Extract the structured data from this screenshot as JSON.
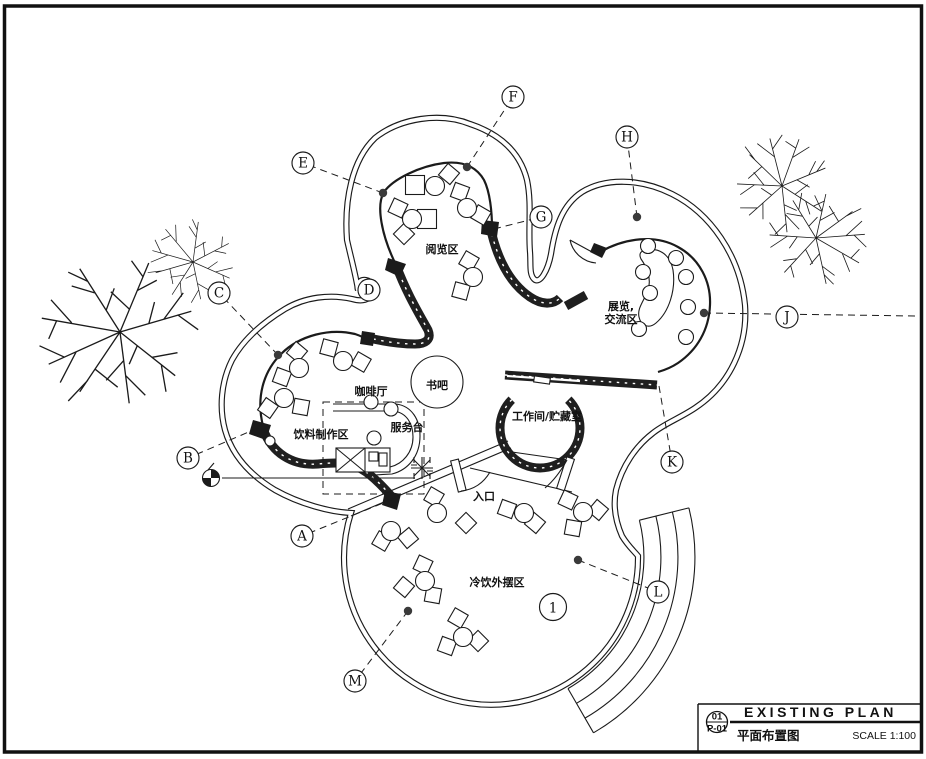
{
  "drawing": {
    "title_block": {
      "detail_number": "01",
      "sheet_number": "P-01",
      "title_en": "EXISTING PLAN",
      "title_zh": "平面布置图",
      "scale_label": "SCALE 1:100"
    },
    "zones": [
      {
        "id": "reading-area",
        "label": "阅览区",
        "x": 442,
        "y": 249
      },
      {
        "id": "exhibition-area",
        "lines": [
          "展览,",
          "交流区"
        ],
        "x": 621,
        "y": 306
      },
      {
        "id": "cafe",
        "label": "咖啡厅",
        "x": 371,
        "y": 391
      },
      {
        "id": "book-bar",
        "label": "书吧",
        "x": 437,
        "y": 385
      },
      {
        "id": "service-desk",
        "label": "服务台",
        "x": 407,
        "y": 427
      },
      {
        "id": "beverage-prep",
        "label": "饮料制作区",
        "x": 321,
        "y": 434
      },
      {
        "id": "workroom-storage",
        "label": "工作间/贮藏室",
        "x": 547,
        "y": 416
      },
      {
        "id": "entrance",
        "label": "入口",
        "x": 484,
        "y": 496
      },
      {
        "id": "outdoor-seating",
        "label": "冷饮外摆区",
        "x": 497,
        "y": 582
      }
    ],
    "markers": [
      {
        "label": "A",
        "x": 302,
        "y": 536,
        "ax": 393,
        "ay": 499
      },
      {
        "label": "B",
        "x": 188,
        "y": 458,
        "ax": 258,
        "ay": 428
      },
      {
        "label": "C",
        "x": 219,
        "y": 293,
        "ax": 278,
        "ay": 355,
        "dot": true
      },
      {
        "label": "D",
        "x": 369,
        "y": 290
      },
      {
        "label": "E",
        "x": 303,
        "y": 163,
        "ax": 383,
        "ay": 193,
        "dot": true
      },
      {
        "label": "F",
        "x": 513,
        "y": 97,
        "ax": 467,
        "ay": 167,
        "dot": true
      },
      {
        "label": "G",
        "x": 541,
        "y": 217,
        "ax": 494,
        "ay": 229
      },
      {
        "label": "H",
        "x": 627,
        "y": 137,
        "ax": 637,
        "ay": 217,
        "dot": true
      },
      {
        "label": "J",
        "x": 787,
        "y": 317,
        "ax": 704,
        "ay": 313,
        "dot": true,
        "ext_x": 916,
        "ext_y": 316
      },
      {
        "label": "K",
        "x": 672,
        "y": 462,
        "ax": 659,
        "ay": 386
      },
      {
        "label": "L",
        "x": 658,
        "y": 592,
        "ax": 578,
        "ay": 560,
        "dot": true
      },
      {
        "label": "M",
        "x": 355,
        "y": 681,
        "ax": 408,
        "ay": 611,
        "dot": true
      }
    ],
    "number_markers": [
      {
        "label": "1",
        "x": 553,
        "y": 607
      }
    ]
  }
}
